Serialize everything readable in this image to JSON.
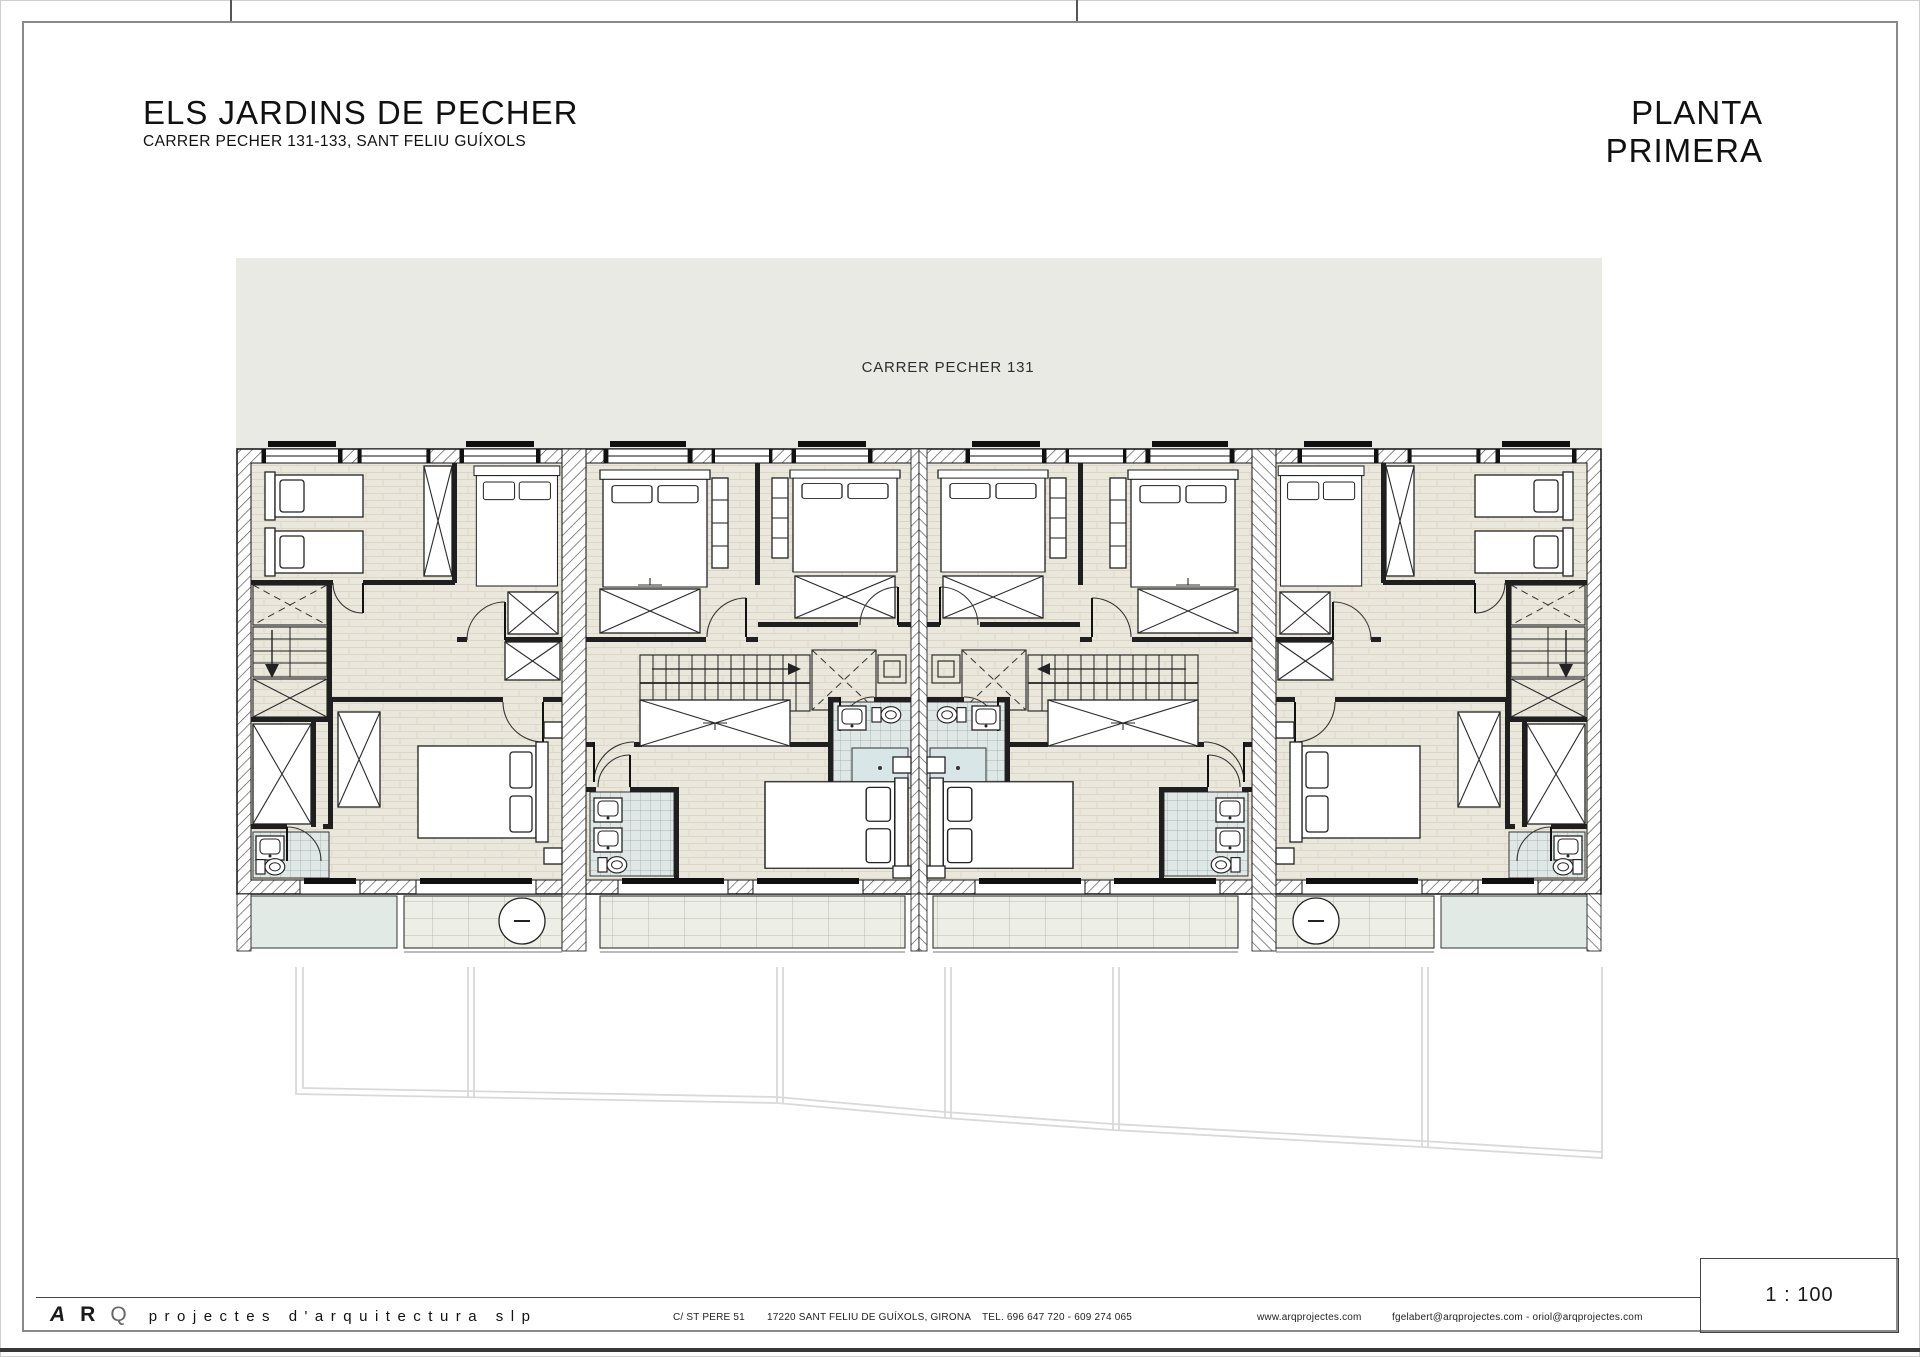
{
  "header": {
    "title": "ELS JARDINS DE PECHER",
    "subtitle": "CARRER PECHER 131-133, SANT FELIU GUÍXOLS",
    "sheet_title": "PLANTA PRIMERA"
  },
  "plan": {
    "street_label": "CARRER PECHER 131"
  },
  "footer": {
    "logo": {
      "a": "A",
      "r": "R",
      "q": "Q"
    },
    "firm_name": "projectes d'arquitectura slp",
    "address": "C/ ST PERE 51",
    "city": "17220 SANT FELIU DE GUÍXOLS, GIRONA",
    "phone": "TEL. 696 647 720 - 609 274 065",
    "website": "www.arqprojectes.com",
    "emails": "fgelabert@arqprojectes.com - oriol@arqprojectes.com",
    "scale": "1 : 100"
  },
  "colors": {
    "paper": "#ffffff",
    "street_band": "#e9eae3",
    "floor": "#eae7dc",
    "floor_line": "#d9d2c2",
    "tile": "#dfe8e6",
    "tile_line": "#93a29e",
    "terrace": "#e2eae6",
    "deck": "#edeee6",
    "line": "#1c1c1c",
    "plot_line": "#d9d9d9",
    "frame": "#8a8a8a",
    "shower": "#d9e6e8"
  }
}
